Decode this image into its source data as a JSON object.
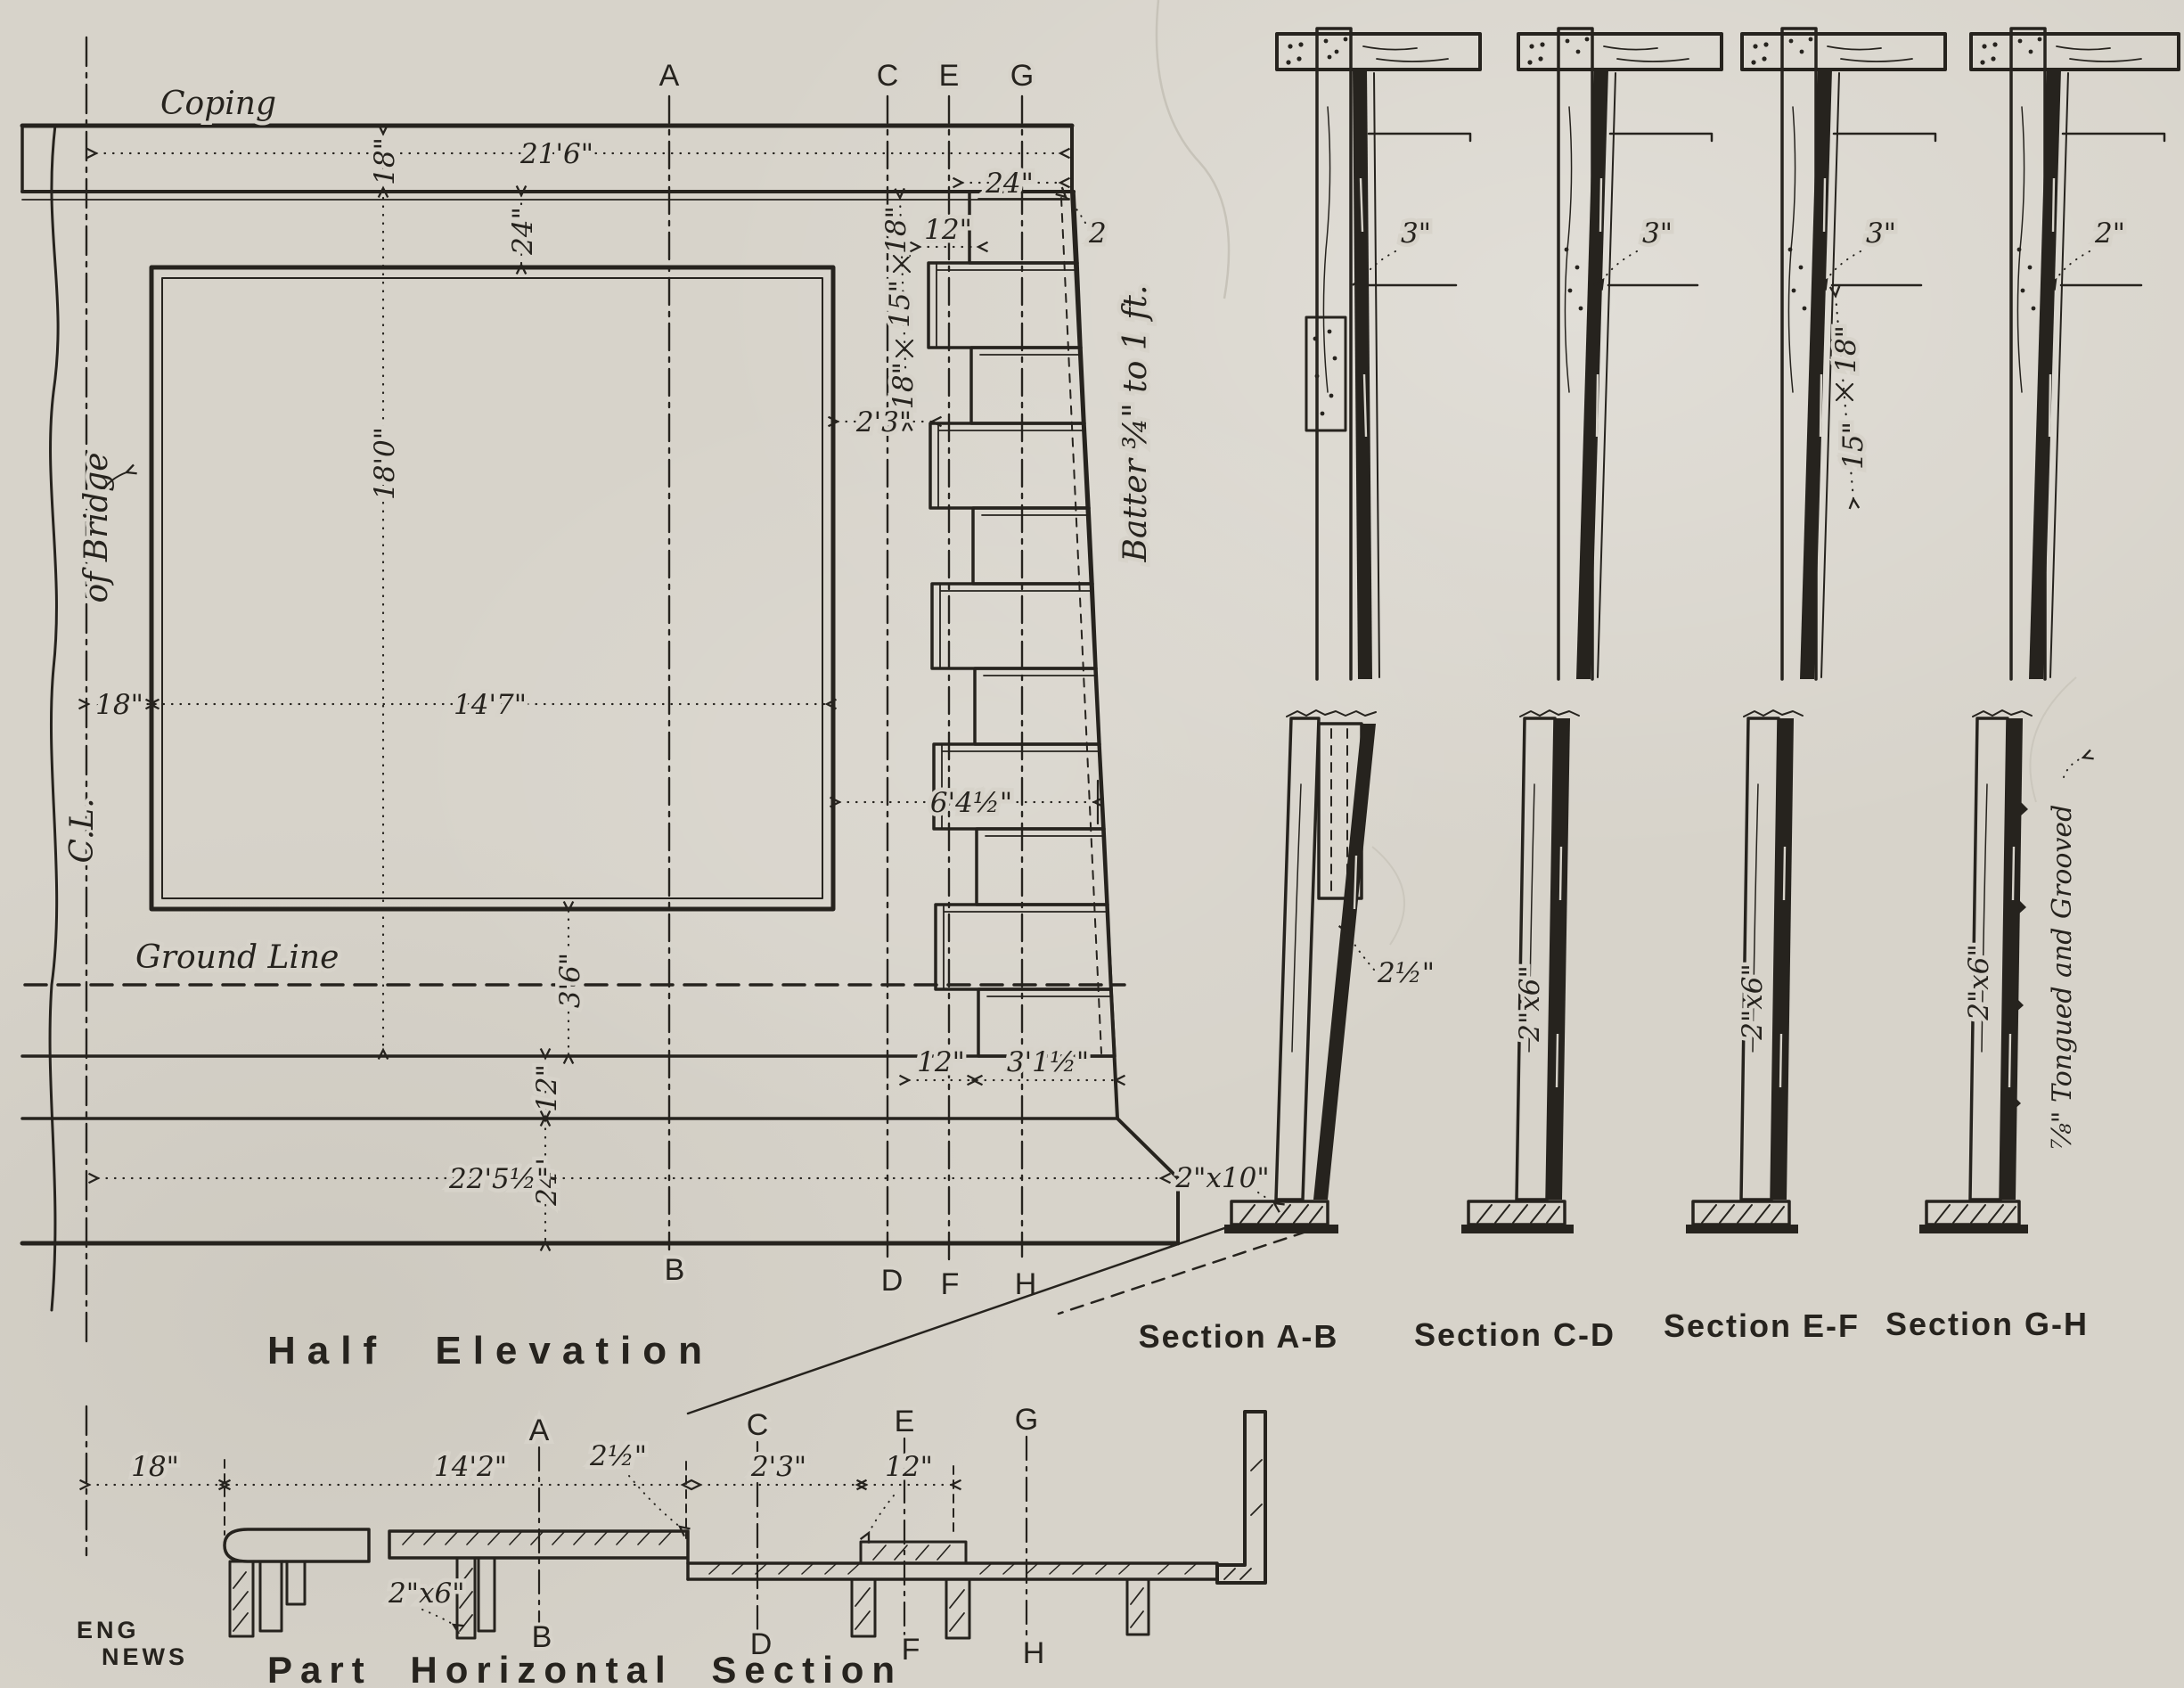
{
  "drawing": {
    "half_elevation": {
      "title": "Half Elevation",
      "coping": "Coping",
      "ground_line": "Ground Line",
      "center_line": "C.L.",
      "of_bridge": "of Bridge",
      "batter": "Batter ¾\" to 1 ft.",
      "letters_top": [
        "A",
        "C",
        "E",
        "G"
      ],
      "letters_bottom": [
        "B",
        "D",
        "F",
        "H"
      ],
      "dims": {
        "coping_length": "21'6\"",
        "coping_height": "18\"",
        "coping_to_panel": "24\"",
        "coping_end": "24\"",
        "top_step": "2",
        "board1": "18\"",
        "board2": "15\"",
        "board3": "18\"",
        "board_offset": "12\"",
        "cleat_spacing": "2'3\"",
        "wall_height": "18'0\"",
        "cl_to_panel": "18\"",
        "panel_width": "14'7\"",
        "mid_width": "6'4½\"",
        "panel_to_base": "3'6\"",
        "base_course1": "12\"",
        "base_course2": "24\"",
        "base_length": "22'5½\"",
        "base_offset": "12\"",
        "base_toe": "3'1½\""
      }
    },
    "sections": {
      "ab": {
        "title": "Section A-B",
        "plank_gap": "3\"",
        "lap": "2½\"",
        "sill": "2\"x10\""
      },
      "cd": {
        "title": "Section C-D",
        "plank_gap": "3\"",
        "stud": "2\"x6\""
      },
      "ef": {
        "title": "Section E-F",
        "plank_gap": "3\"",
        "space1": "18\"",
        "space2": "15\"",
        "stud": "2\"x6\""
      },
      "gh": {
        "title": "Section G-H",
        "plank_gap": "2\"",
        "stud": "2\"x6\"",
        "sheathing": "⅞\" Tongued and Grooved"
      }
    },
    "plan": {
      "title": "Part Horizontal Section",
      "credit1": "ENG",
      "credit2": "NEWS",
      "letters_top": [
        "A",
        "C",
        "E",
        "G"
      ],
      "letters_bottom": [
        "B",
        "D",
        "F",
        "H"
      ],
      "dims": {
        "cl_offset": "18\"",
        "half_length": "14'2\"",
        "lap": "2½\"",
        "spacing": "2'3\"",
        "offset": "12\"",
        "stud": "2\"x6\""
      }
    }
  }
}
